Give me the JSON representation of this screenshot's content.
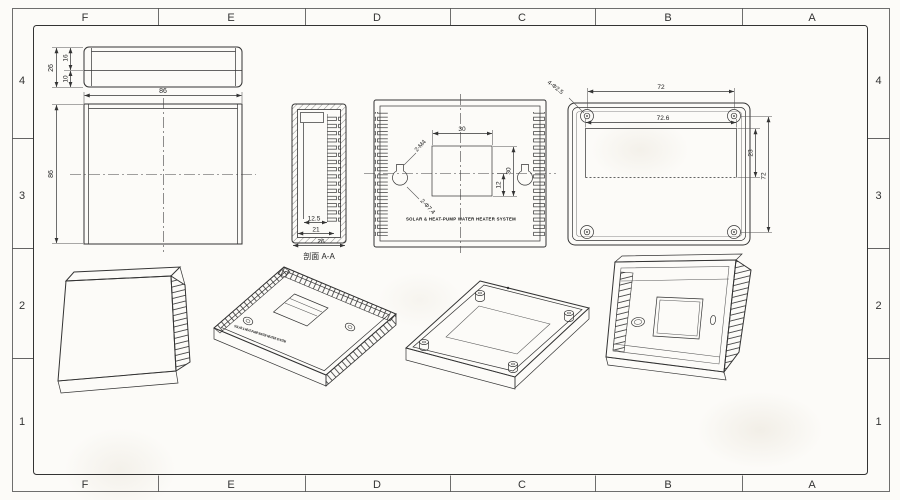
{
  "sheet": {
    "columns": [
      "F",
      "E",
      "D",
      "C",
      "B",
      "A"
    ],
    "rows": [
      "4",
      "3",
      "2",
      "1"
    ]
  },
  "front_view": {
    "dim_width": "86",
    "dim_height": "86"
  },
  "profile_view": {
    "dim_total": "26",
    "dim_upper": "16",
    "dim_lower": "10"
  },
  "section_view": {
    "label": "剖面 A-A",
    "dim_inner": "12.5",
    "dim_mid": "21",
    "dim_total": "26"
  },
  "back_view": {
    "dim_window_width": "30",
    "dim_window_height": "30",
    "dim_offset": "12",
    "screw_callout": "2-M4",
    "hole_callout": "2-Φ7.4",
    "brand": "SOLAR & HEAT-PUMP WATER HEATER SYSTEM"
  },
  "base_view": {
    "dim_screw_span_h": "72",
    "dim_recess_width": "72.6",
    "dim_recess_height": "23",
    "dim_screw_span_v": "72",
    "hole_callout": "4-Φ2.5"
  }
}
